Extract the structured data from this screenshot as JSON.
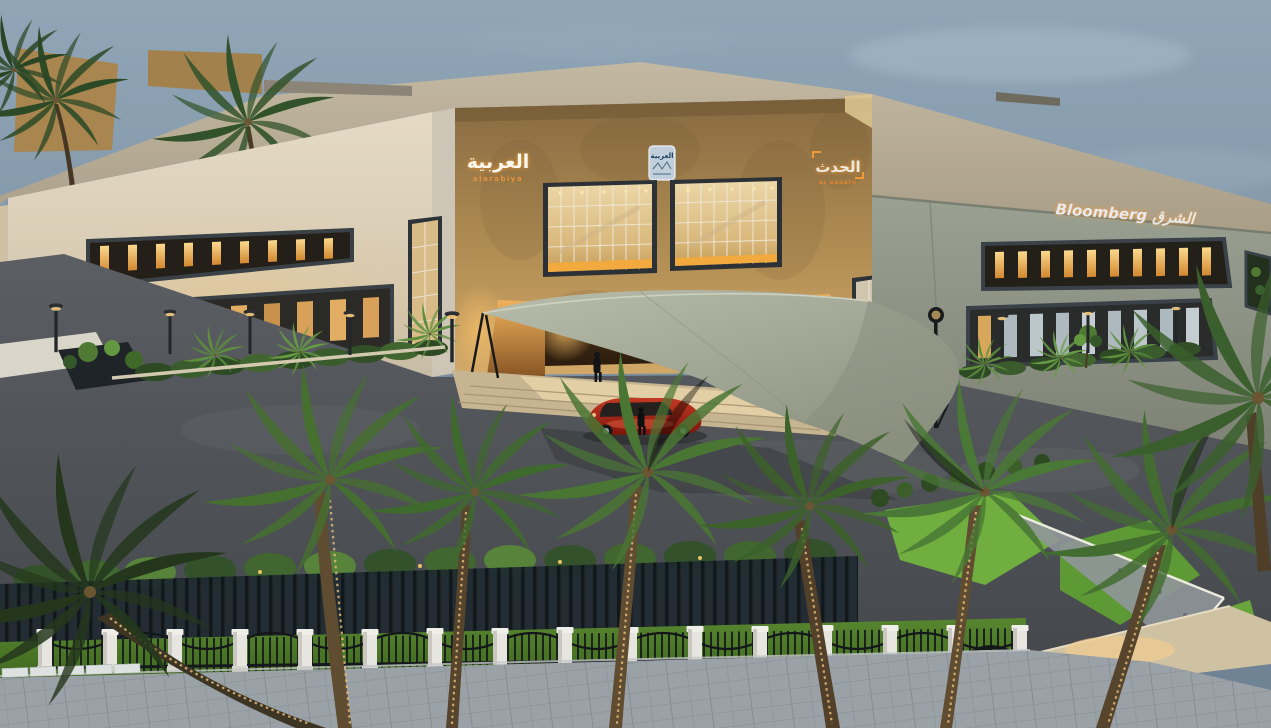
{
  "canvas": {
    "width": 1271,
    "height": 728
  },
  "scene": {
    "description": "Dusk aerial architectural rendering of a two-storey sand-coloured broadcast headquarters with a stone media tower, glass curtain walls, a grey tensile shade sail over the entry drive, a red sports car, date palms, lawns, an ornamental fence and a paver sidewalk in the foreground.",
    "sky_color": "#7b8fa1",
    "building": {
      "left_wing_color": "#d5c9b2",
      "tower_color": "#a9874f",
      "right_wing_color": "#8d9284",
      "roof_color": "#b5aa94",
      "window_glow_color": "#eaa64e",
      "upper_window_slots_left": 9,
      "upper_window_slots_right": 10,
      "ground_floor_windows_left": 8,
      "ground_floor_windows_right": 9
    },
    "signs": {
      "alarabiya": {
        "arabic": "العربية",
        "latin": "alarabiya"
      },
      "badge": {
        "arabic": "العربية"
      },
      "alhadath": {
        "arabic": "الحدث",
        "latin": "AL HADATH"
      },
      "bloomberg": {
        "text": "Bloomberg الشرق"
      }
    },
    "canopy": {
      "type": "tensile shade sail",
      "color": "#9ba08d"
    },
    "vehicle": {
      "type": "sports car",
      "color": "#a42619"
    },
    "people_count": 2,
    "foreground": {
      "palm_count": 8,
      "fence_pillar_count": 16,
      "lawn_color": "#69a53b",
      "sidewalk_color": "#99a1a6",
      "asphalt_color": "#515458"
    }
  }
}
